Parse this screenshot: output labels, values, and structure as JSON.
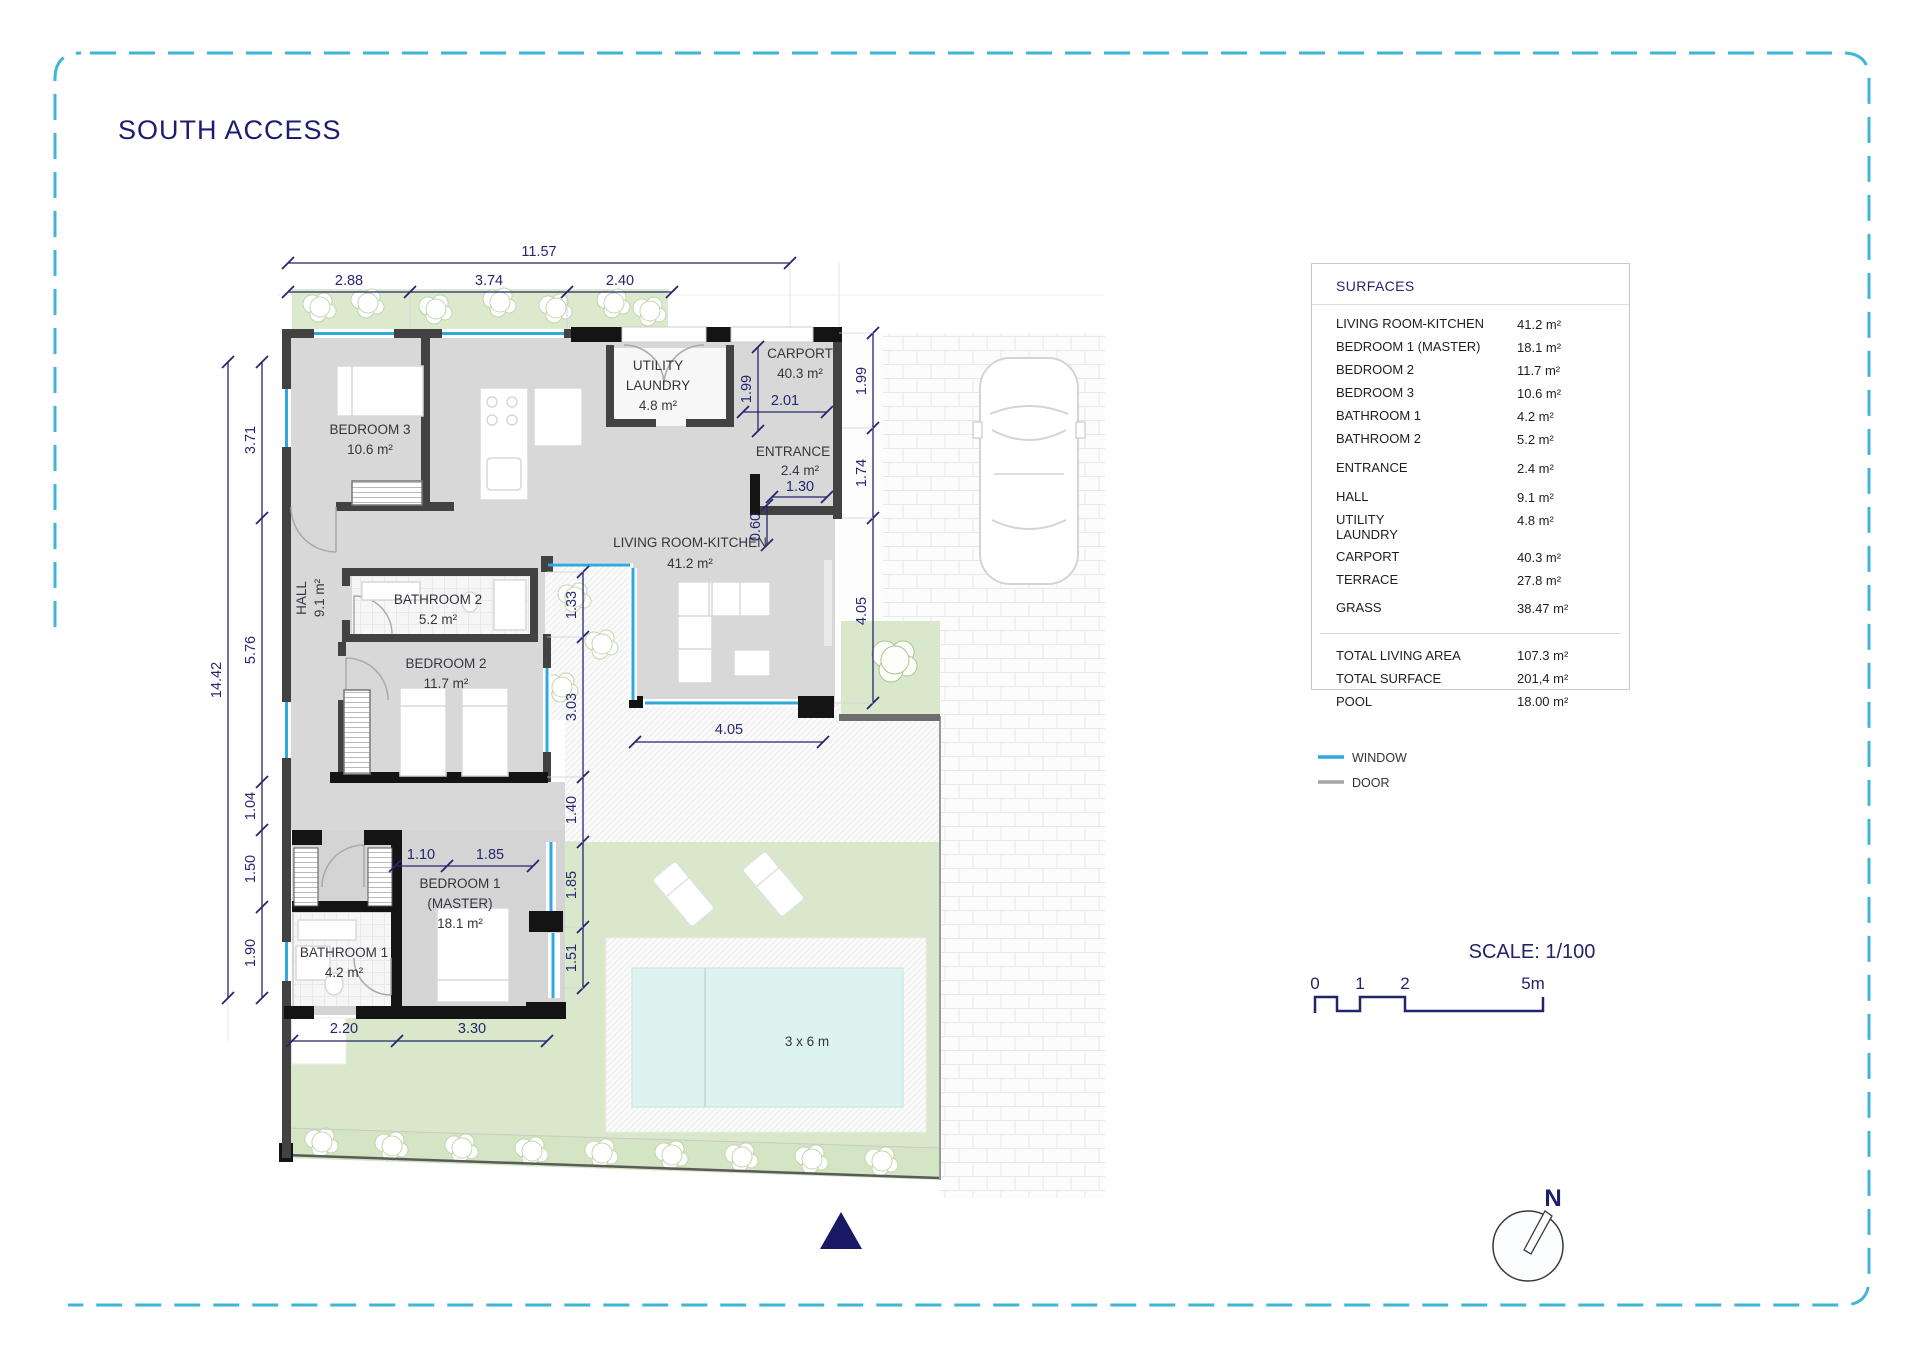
{
  "title": "SOUTH ACCESS",
  "surfaces": {
    "header": "SURFACES",
    "rows": [
      {
        "label": "LIVING ROOM-KITCHEN",
        "value": "41.2 m²"
      },
      {
        "label": "BEDROOM 1 (MASTER)",
        "value": "18.1 m²"
      },
      {
        "label": "BEDROOM 2",
        "value": "11.7 m²"
      },
      {
        "label": "BEDROOM 3",
        "value": "10.6 m²"
      },
      {
        "label": "BATHROOM 1",
        "value": "4.2 m²"
      },
      {
        "label": "BATHROOM 2",
        "value": "5.2 m²"
      },
      {
        "label": "ENTRANCE",
        "value": "2.4 m²"
      },
      {
        "label": "HALL",
        "value": "9.1 m²"
      },
      {
        "label": "UTILITY\nLAUNDRY",
        "value": "4.8 m²"
      },
      {
        "label": "CARPORT",
        "value": "40.3 m²"
      },
      {
        "label": "TERRACE",
        "value": "27.8 m²"
      },
      {
        "label": "GRASS",
        "value": "38.47 m²"
      }
    ],
    "totals": [
      {
        "label": "TOTAL LIVING AREA",
        "value": "107.3 m²"
      },
      {
        "label": "TOTAL SURFACE",
        "value": "201,4 m²"
      },
      {
        "label": "POOL",
        "value": "18.00 m²"
      }
    ]
  },
  "legend": {
    "window_label": "WINDOW",
    "door_label": "DOOR",
    "window_color": "#2fa9dd",
    "door_color": "#a0a4a7"
  },
  "scale_bar": {
    "title": "SCALE: 1/100",
    "tick0": "0",
    "tick1": "1",
    "tick2": "2",
    "tick3": "5m"
  },
  "compass": {
    "label": "N"
  },
  "plan": {
    "rooms": {
      "bedroom3": {
        "name": "BEDROOM 3",
        "area": "10.6 m²"
      },
      "utility": {
        "name1": "UTILITY",
        "name2": "LAUNDRY",
        "area": "4.8 m²"
      },
      "carport": {
        "name": "CARPORT",
        "area": "40.3 m²"
      },
      "entrance": {
        "name": "ENTRANCE",
        "area": "2.4 m²"
      },
      "living": {
        "name": "LIVING ROOM-KITCHEN",
        "area": "41.2 m²"
      },
      "hall": {
        "name": "HALL",
        "area": "9.1 m²"
      },
      "bathroom2": {
        "name": "BATHROOM 2",
        "area": "5.2 m²"
      },
      "bedroom2": {
        "name": "BEDROOM 2",
        "area": "11.7 m²"
      },
      "bedroom1": {
        "name": "BEDROOM 1",
        "name2": "(MASTER)",
        "area": "18.1 m²"
      },
      "bathroom1": {
        "name": "BATHROOM 1",
        "area": "4.2 m²"
      },
      "pool_label": "3 x 6 m"
    },
    "dims": {
      "w_total": "11.57",
      "w1": "2.88",
      "w2": "3.74",
      "w3": "2.40",
      "h_total": "14.42",
      "l1": "3.71",
      "l2": "5.76",
      "l3": "1.04",
      "l4": "1.50",
      "l5": "1.90",
      "r1": "1.99",
      "r2": "1.74",
      "r3": "4.05",
      "e1": "1.99",
      "e2": "2.01",
      "e3": "1.30",
      "e4": "0.60",
      "m1": "1.33",
      "m2": "3.03",
      "m3": "1.40",
      "m4": "1.85",
      "m5": "1.51",
      "b1": "1.10",
      "b2": "1.85",
      "b3": "2.20",
      "b4": "3.30",
      "t1": "4.05"
    }
  }
}
